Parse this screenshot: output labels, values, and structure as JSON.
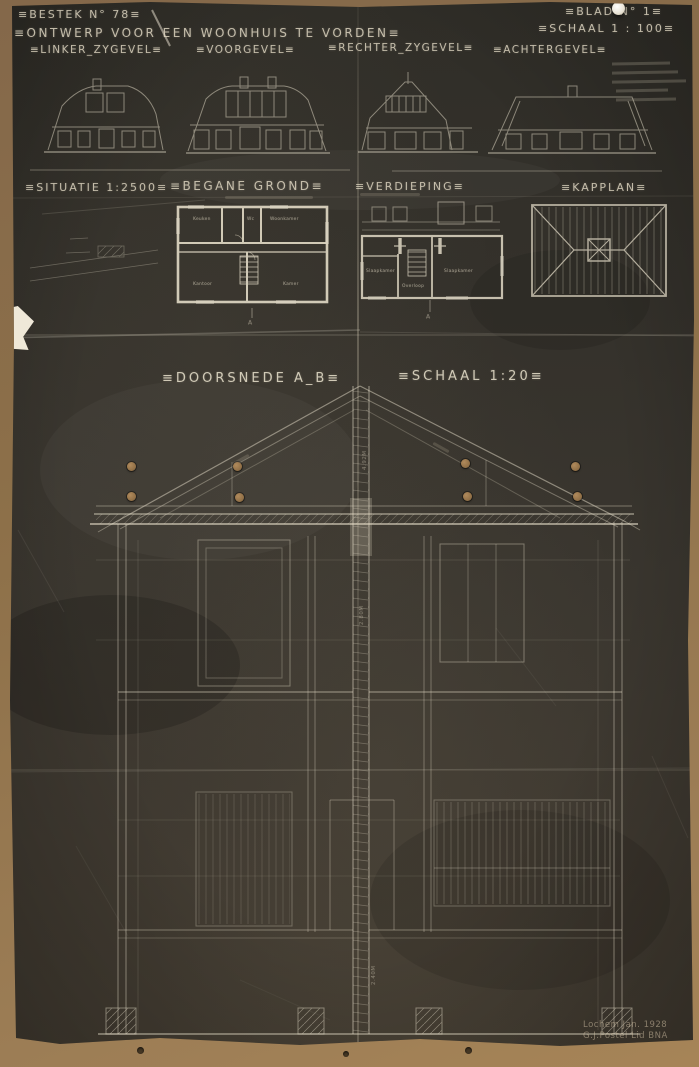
{
  "titleblock": {
    "bestek": "≡BESTEK  N° 78≡",
    "title": "≡ONTWERP  VOOR  EEN  WOONHUIS  TE  VORDEN≡",
    "blad": "≡BLAD  N° 1≡",
    "schaal": "≡SCHAAL  1 : 100≡"
  },
  "elevations": {
    "linker": "≡LINKER_ZYGEVEL≡",
    "voor": "≡VOORGEVEL≡",
    "rechter": "≡RECHTER_ZYGEVEL≡",
    "achter": "≡ACHTERGEVEL≡"
  },
  "plans": {
    "situatie": "≡SITUATIE  1:2500≡",
    "begane_grond": "≡BEGANE GROND≡",
    "verdieping": "≡VERDIEPING≡",
    "kapplan": "≡KAPPLAN≡"
  },
  "rooms": {
    "keuken": "Keuken",
    "wc": "Wc",
    "woonkamer": "Woonkamer",
    "kantoor": "Kantoor",
    "kamer": "Kamer",
    "slaapkamer1": "Slaapkamer",
    "overloop": "Overloop",
    "slaapkamer2": "Slaapkamer"
  },
  "section": {
    "title": "≡DOORSNEDE  A_B≡",
    "scale": "≡SCHAAL  1:20≡",
    "marker": "A",
    "dim_roof": "4.92M",
    "dim_upper": "2.80M",
    "dim_lower": "2.40M"
  },
  "signature": {
    "line1": "Lochem  Jan. 1928",
    "line2": "G.J.Postel  Lid BNA"
  },
  "colors": {
    "paper": "#36322b",
    "ink": "#e8e0cb",
    "table": "#8f744e"
  }
}
